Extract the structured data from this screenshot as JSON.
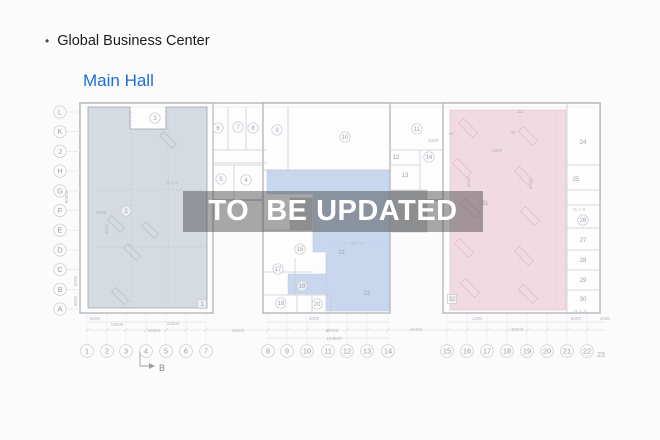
{
  "header": {
    "bullet": "•",
    "title": "Global Business Center",
    "subtitle": "Main Hall"
  },
  "watermark": "TO  BE UPDATED",
  "colors": {
    "link_blue": "#1a6fd8",
    "left_zone": "#d6dbe2",
    "center_zone": "#c9d7ee",
    "right_zone": "#f2dae2",
    "watermark_band": "rgba(60,60,60,0.44)",
    "plan_line": "#b4b8bd"
  },
  "plan": {
    "row_axis": [
      "L",
      "K",
      "J",
      "H",
      "G",
      "F",
      "E",
      "D",
      "C",
      "B",
      "A"
    ],
    "col_axis": [
      {
        "label": "1",
        "x": 87
      },
      {
        "label": "2",
        "x": 107
      },
      {
        "label": "3",
        "x": 126
      },
      {
        "label": "4",
        "x": 146
      },
      {
        "label": "5",
        "x": 166
      },
      {
        "label": "6",
        "x": 186
      },
      {
        "label": "7",
        "x": 206
      },
      {
        "label": "8",
        "x": 268
      },
      {
        "label": "9",
        "x": 287
      },
      {
        "label": "10",
        "x": 307
      },
      {
        "label": "11",
        "x": 328
      },
      {
        "label": "12",
        "x": 347
      },
      {
        "label": "13",
        "x": 367
      },
      {
        "label": "14",
        "x": 388
      },
      {
        "label": "15",
        "x": 447
      },
      {
        "label": "16",
        "x": 467
      },
      {
        "label": "17",
        "x": 487
      },
      {
        "label": "18",
        "x": 507
      },
      {
        "label": "19",
        "x": 527
      },
      {
        "label": "20",
        "x": 547
      },
      {
        "label": "21",
        "x": 567
      },
      {
        "label": "22",
        "x": 587
      },
      {
        "label": "23",
        "x": 601,
        "small": true
      }
    ],
    "rooms": [
      {
        "n": "1",
        "x": 202,
        "y": 304,
        "sq": true
      },
      {
        "n": "2",
        "x": 126,
        "y": 211
      },
      {
        "n": "3",
        "x": 155,
        "y": 118
      },
      {
        "n": "4",
        "x": 246,
        "y": 180
      },
      {
        "n": "5",
        "x": 221,
        "y": 179
      },
      {
        "n": "6",
        "x": 218,
        "y": 128
      },
      {
        "n": "7",
        "x": 238,
        "y": 127
      },
      {
        "n": "8",
        "x": 253,
        "y": 128
      },
      {
        "n": "9",
        "x": 277,
        "y": 130
      },
      {
        "n": "10",
        "x": 345,
        "y": 137
      },
      {
        "n": "11",
        "x": 417,
        "y": 129
      },
      {
        "n": "12",
        "x": 396,
        "y": 157,
        "plain": true
      },
      {
        "n": "13",
        "x": 405,
        "y": 175,
        "plain": true
      },
      {
        "n": "14",
        "x": 429,
        "y": 157
      },
      {
        "n": "15",
        "x": 300,
        "y": 249
      },
      {
        "n": "17",
        "x": 278,
        "y": 269
      },
      {
        "n": "18",
        "x": 281,
        "y": 303
      },
      {
        "n": "19",
        "x": 302,
        "y": 286
      },
      {
        "n": "20",
        "x": 317,
        "y": 304
      },
      {
        "n": "21",
        "x": 342,
        "y": 252,
        "plain": true
      },
      {
        "n": "22",
        "x": 367,
        "y": 293,
        "plain": true
      },
      {
        "n": "24",
        "x": 583,
        "y": 142,
        "plain": true
      },
      {
        "n": "25",
        "x": 576,
        "y": 179,
        "plain": true
      },
      {
        "n": "26",
        "x": 583,
        "y": 220
      },
      {
        "n": "27",
        "x": 583,
        "y": 240,
        "plain": true
      },
      {
        "n": "28",
        "x": 583,
        "y": 260,
        "plain": true
      },
      {
        "n": "29",
        "x": 583,
        "y": 280,
        "plain": true
      },
      {
        "n": "30",
        "x": 583,
        "y": 299,
        "plain": true
      },
      {
        "n": "31",
        "x": 485,
        "y": 203,
        "plain": true
      },
      {
        "n": "32",
        "x": 452,
        "y": 299,
        "sq": true
      }
    ],
    "dim_bottom": [
      {
        "t": "6000",
        "x": 95,
        "y": 320
      },
      {
        "t": "18000",
        "x": 117,
        "y": 326
      },
      {
        "t": "36000",
        "x": 154,
        "y": 332
      },
      {
        "t": "18000",
        "x": 173,
        "y": 325
      },
      {
        "t": "18000",
        "x": 238,
        "y": 332
      },
      {
        "t": "2000",
        "x": 314,
        "y": 320
      },
      {
        "t": "36000",
        "x": 332,
        "y": 332
      },
      {
        "t": "153663",
        "x": 334,
        "y": 340
      },
      {
        "t": "18400",
        "x": 416,
        "y": 331
      },
      {
        "t": "1300",
        "x": 477,
        "y": 320
      },
      {
        "t": "45000",
        "x": 517,
        "y": 331
      },
      {
        "t": "6000",
        "x": 576,
        "y": 320
      },
      {
        "t": "3000",
        "x": 605,
        "y": 320
      }
    ],
    "dim_vertical": [
      {
        "t": "60000",
        "x": 68,
        "y": 197
      },
      {
        "t": "6000",
        "x": 77,
        "y": 281
      },
      {
        "t": "6000",
        "x": 77,
        "y": 301
      },
      {
        "t": "3000",
        "x": 108,
        "y": 229
      },
      {
        "t": "6000",
        "x": 470,
        "y": 182
      },
      {
        "t": "6000",
        "x": 532,
        "y": 184
      }
    ],
    "annotations": [
      {
        "t": "2000",
        "x": 101,
        "y": 214
      },
      {
        "t": "G + 3",
        "x": 172,
        "y": 184
      },
      {
        "t": "G + 3",
        "x": 357,
        "y": 245
      },
      {
        "t": "G + 3",
        "x": 579,
        "y": 211
      },
      {
        "t": "G + 3",
        "x": 580,
        "y": 313
      },
      {
        "t": "1000",
        "x": 433,
        "y": 142
      },
      {
        "t": "1900",
        "x": 497,
        "y": 152
      },
      {
        "t": "45°",
        "x": 452,
        "y": 135
      },
      {
        "t": "45°",
        "x": 514,
        "y": 134
      },
      {
        "t": "23",
        "x": 520,
        "y": 113
      }
    ],
    "section_marker": "B"
  }
}
